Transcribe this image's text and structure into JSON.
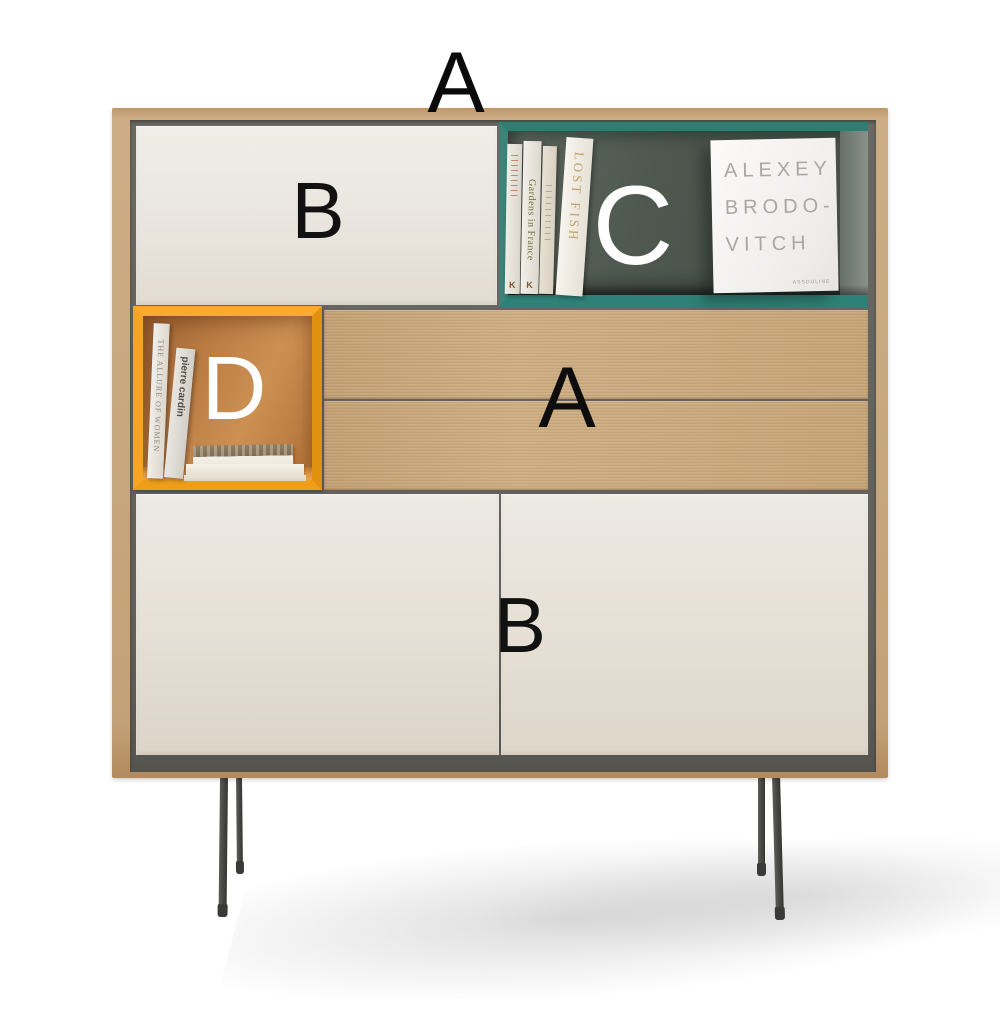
{
  "annotations": {
    "top": "A",
    "upper_door": "B",
    "open_shelf": "C",
    "open_box": "D",
    "drawers": "A",
    "lower_doors": "B"
  },
  "books": {
    "shelf_spine_gardens": "Gardens in France",
    "shelf_spine_lost_fish": "LOST FISH",
    "shelf_spine_logo": "K",
    "big_book_line1": "ALEXEY",
    "big_book_line2": "BRODO-",
    "big_book_line3": "VITCH",
    "big_book_publisher": "ASSOULINE",
    "box_spine_allure": "THE ALLURE OF WOMEN",
    "box_spine_cardin": "pierre cardin"
  },
  "colors": {
    "background": "#ffffff",
    "wood": "#c8a87f",
    "door_cream": "#e9e4dc",
    "carcass_gray": "#63615a",
    "shelf_teal": "#2f7d72",
    "shelf_interior_green": "#4d574e",
    "box_orange": "#f5a522",
    "box_interior_orange": "#c2824a",
    "leg_gray": "#4c4c4a",
    "label_black": "#0d0d0d",
    "label_white": "#ffffff"
  }
}
